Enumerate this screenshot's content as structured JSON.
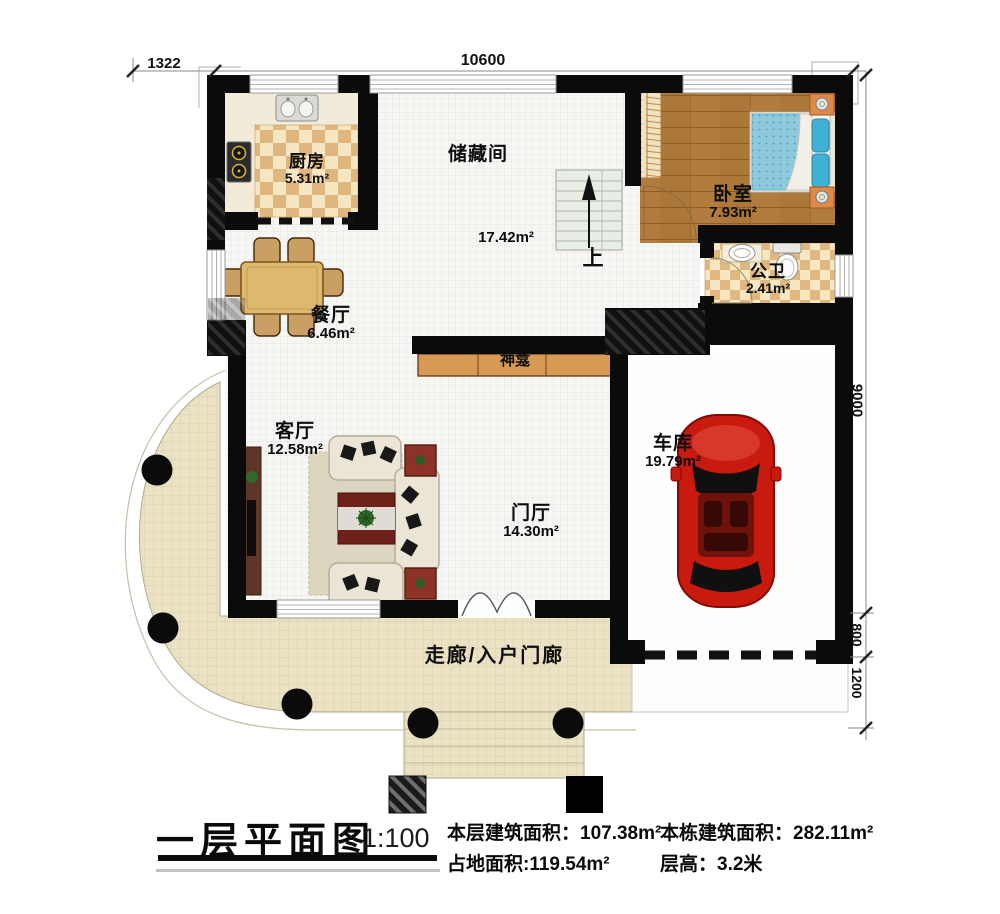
{
  "plan": {
    "dimensions": {
      "left_offset": "1322",
      "top_width": "10600",
      "right_height": "9000",
      "garage_step": "800",
      "driveway_depth": "1200"
    },
    "rooms": {
      "kitchen": {
        "name": "厨房",
        "area": "5.31m²"
      },
      "storage": {
        "name": "储藏间",
        "area": "17.42m²"
      },
      "bedroom": {
        "name": "卧室",
        "area": "7.93m²"
      },
      "bathroom": {
        "name": "公卫",
        "area": "2.41m²"
      },
      "dining": {
        "name": "餐厅",
        "area": "6.46m²"
      },
      "living": {
        "name": "客厅",
        "area": "12.58m²"
      },
      "foyer": {
        "name": "门厅",
        "area": "14.30m²"
      },
      "garage": {
        "name": "车库",
        "area": "19.79m²"
      },
      "shrine": {
        "name": "神龛"
      },
      "porch": {
        "name": "走廊/入户门廊"
      }
    },
    "stairs": {
      "direction_label": "上"
    }
  },
  "title_block": {
    "title": "一层平面图",
    "scale": "1:100",
    "stats": {
      "floor_area_label": "本层建筑面积：",
      "floor_area_value": "107.38m²",
      "building_area_label": "本栋建筑面积：",
      "building_area_value": "282.11m²",
      "footprint_label": "占地面积:",
      "footprint_value": "119.54m²",
      "floor_height_label": "层高：",
      "floor_height_value": "3.2米"
    }
  },
  "colors": {
    "wall": "#0b0b0b",
    "interior_grid_floor": "#f6f6f4",
    "kitchen_tile": "#dfb67e",
    "bathroom_tile": "#e0b87f",
    "bedroom_wood": "#b27c3e",
    "porch_tile": "#ebe2c4",
    "bed_blanket_blue": "#8ecade",
    "car_red": "#c81a0e",
    "furniture_wood": "#ddb96f",
    "shrine_wood": "#d69a55"
  }
}
